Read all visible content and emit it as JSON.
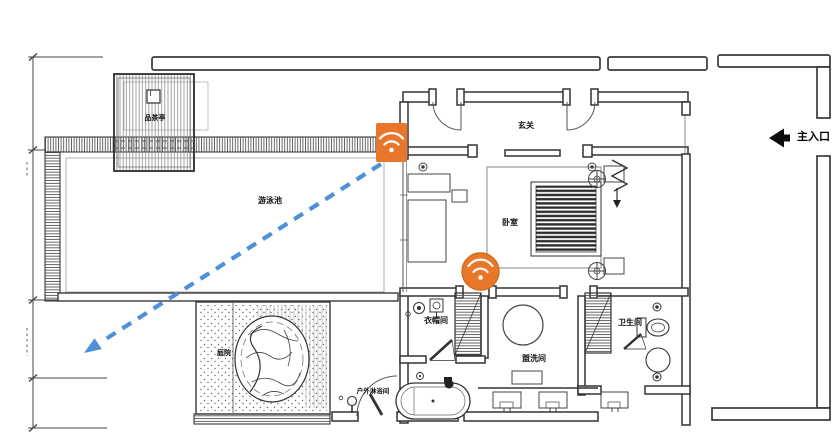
{
  "labels": {
    "pavilion": "品茶亭",
    "pool_area": "游泳池",
    "entry_hall": "玄关",
    "bedroom": "卧室",
    "cloakroom": "衣帽间",
    "washroom": "盥洗间",
    "bathroom": "卫生间",
    "outdoor_shower": "户外淋浴间",
    "rock_courtyard": "庭院",
    "main_entrance": "主入口"
  },
  "colors": {
    "wifi_orange": "#E8772A",
    "signal_blue": "#4E90D9",
    "line_dark": "#3A3A3A"
  },
  "icons": {
    "router": "wifi-icon",
    "extender": "wifi-icon",
    "entrance": "left-arrow-icon",
    "signal": "dashed-arrow-icon"
  }
}
